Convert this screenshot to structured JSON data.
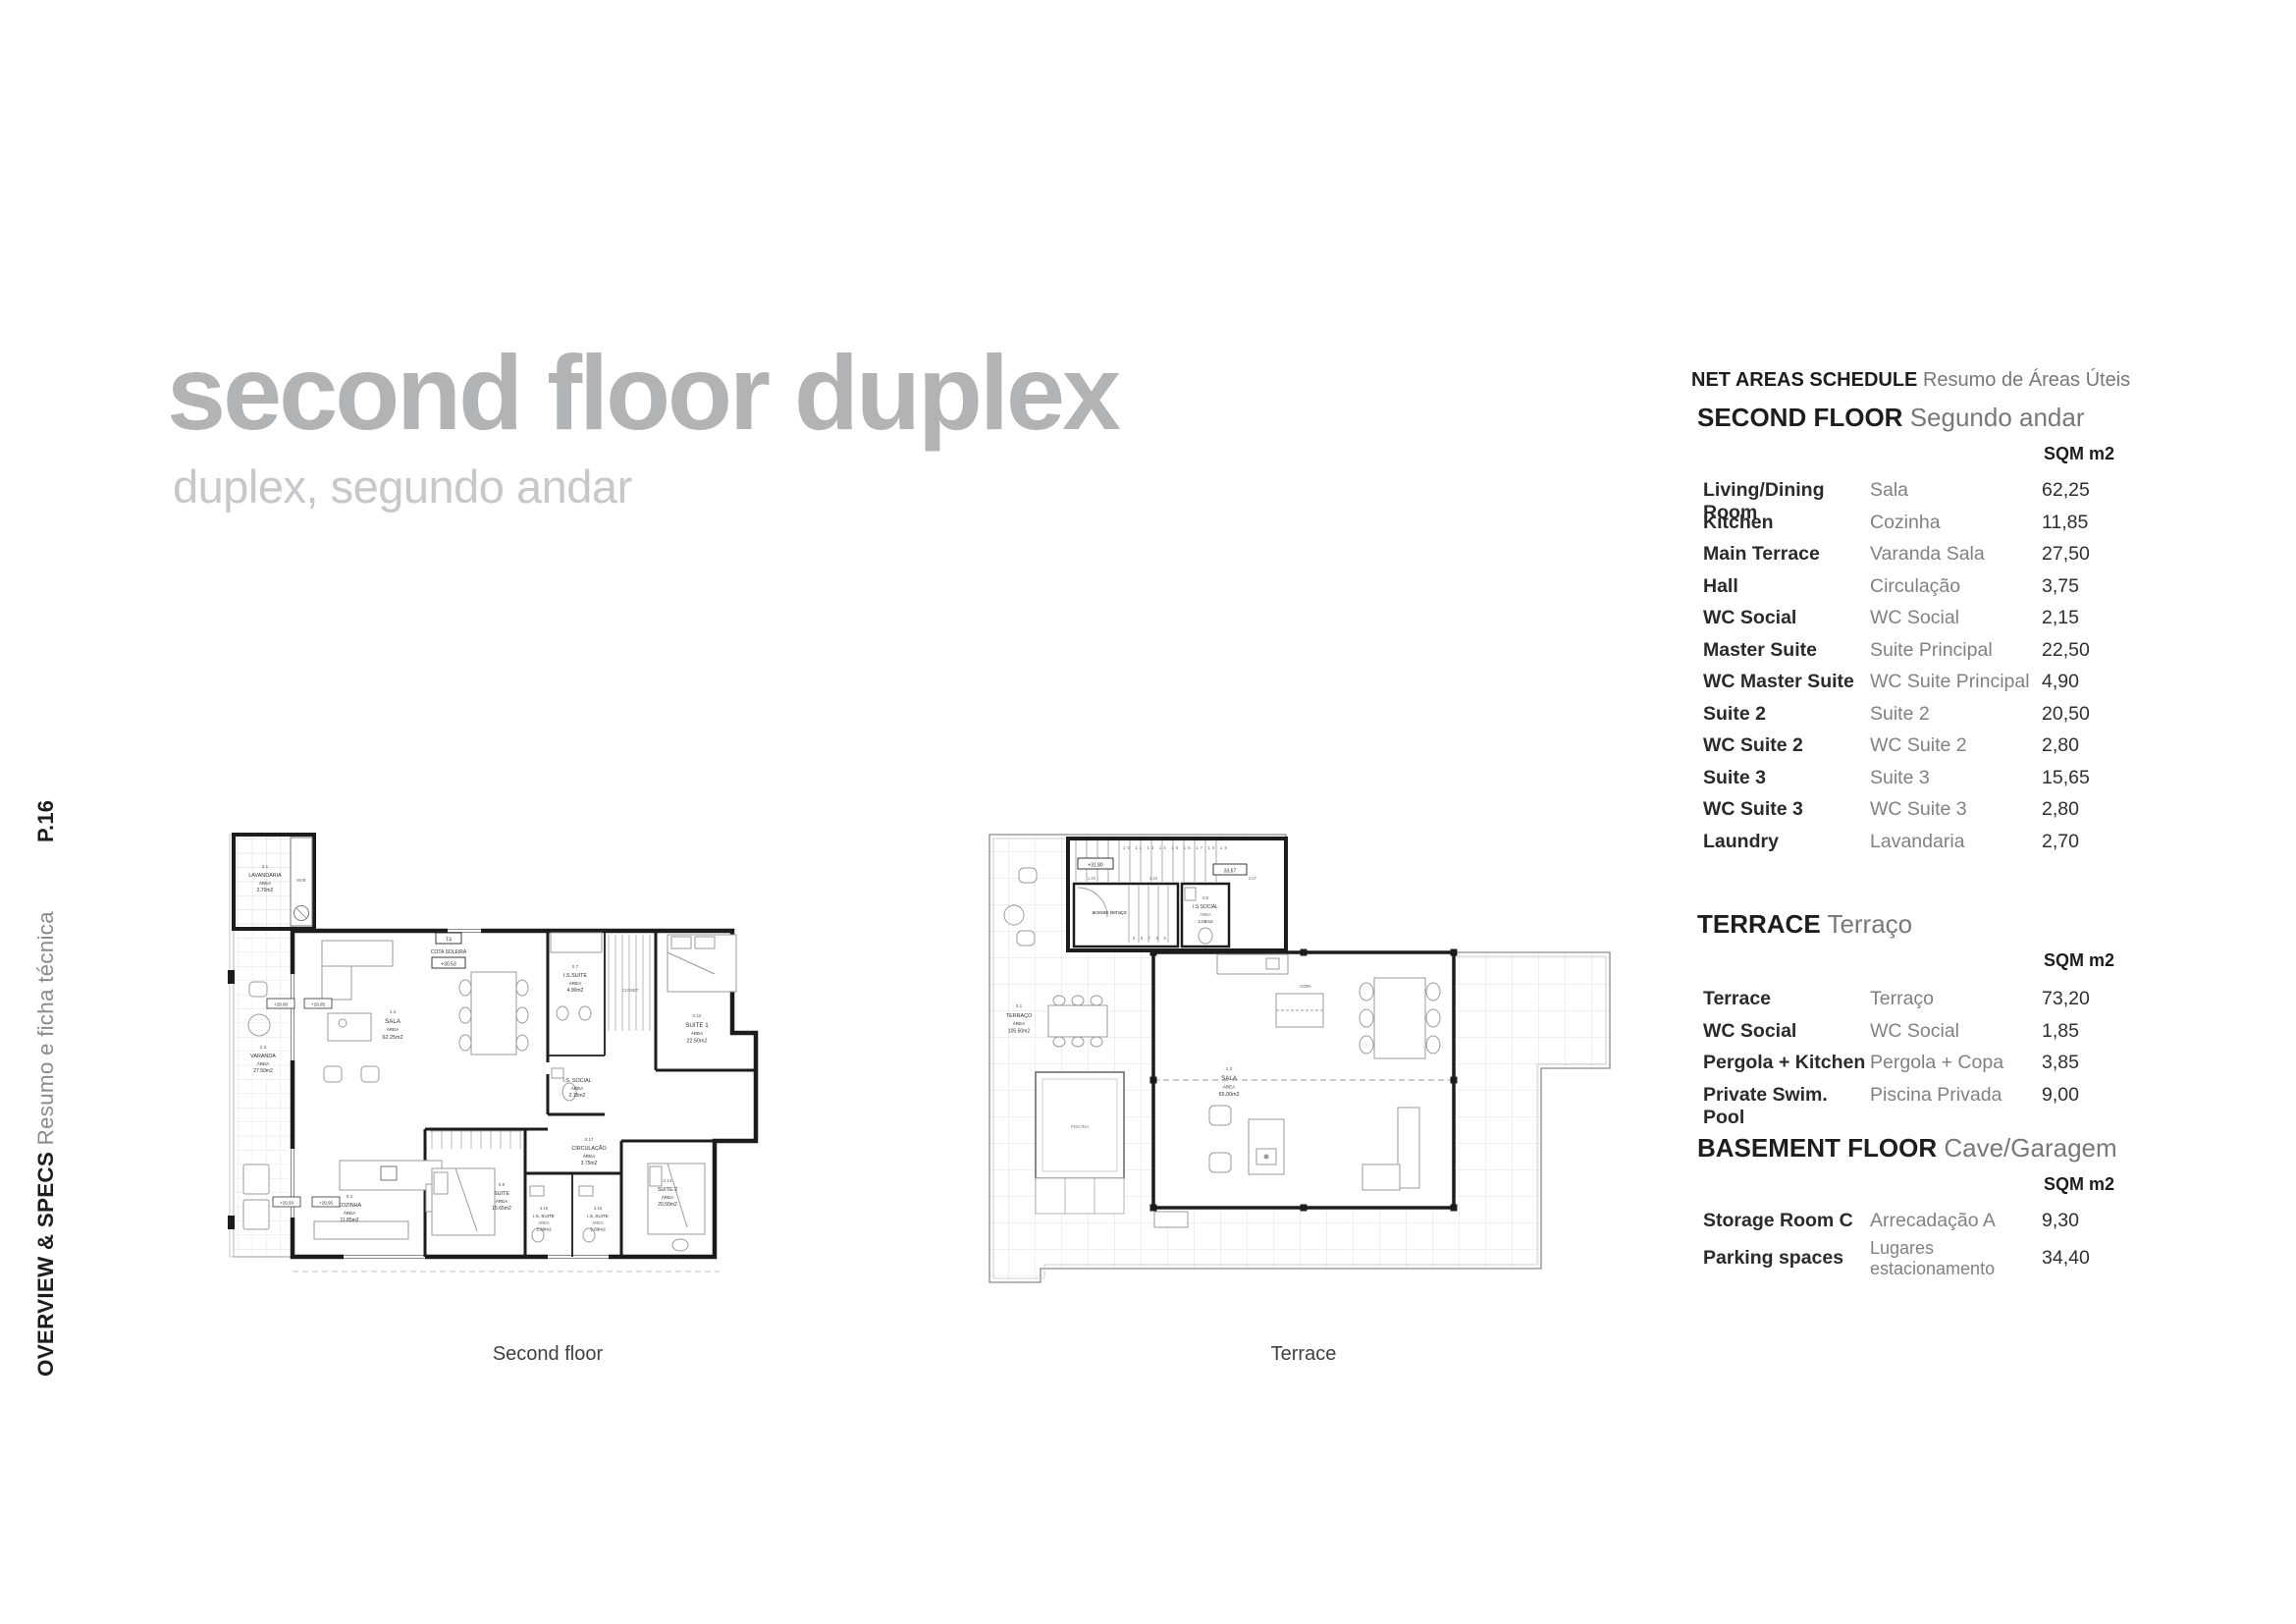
{
  "sidebar": {
    "page_number": "P.16",
    "section_title_en": "OVERVIEW & SPECS",
    "section_title_pt": "Resumo e ficha técnica"
  },
  "header": {
    "title": "second floor duplex",
    "subtitle": "duplex, segundo andar"
  },
  "plans": {
    "area_word": "ÁREA",
    "second_floor": {
      "caption": "Second floor",
      "rooms": {
        "lavandaria": {
          "code": "3.1",
          "name": "LAVANDARIA",
          "area": "2.70m2"
        },
        "varanda": {
          "code": "2.3",
          "name": "VARANDA",
          "area": "27.50m2"
        },
        "sala": {
          "code": "1.3",
          "name": "SALA",
          "area": "62.25m2"
        },
        "is_suite": {
          "code": "0.7",
          "name": "I.S.SUITE",
          "area": "4.90m2"
        },
        "closet": {
          "name": "CLOSET"
        },
        "suite1": {
          "code": "0.12",
          "name": "SUITE 1",
          "area": "22.50m2"
        },
        "is_social": {
          "name": "I.S. SOCIAL",
          "area": "2.15m2"
        },
        "circulacao": {
          "code": "3.17",
          "name": "CIRCULAÇÃO",
          "area": "3.75m2"
        },
        "cozinha": {
          "code": "0.4",
          "name": "COZINHA",
          "area": "11.85m2"
        },
        "suite3": {
          "code": "0.9",
          "name": "SUITE",
          "area": "15.65m2"
        },
        "is_suite_a": {
          "code": "3.16",
          "name": "I.S. SUITE",
          "area": "2.80m2"
        },
        "is_suite_b": {
          "code": "3.15",
          "name": "I.S. SUITE",
          "area": "2.80m2"
        },
        "suite2": {
          "code": "2.14",
          "name": "SUITE 2",
          "area": "20.50m2"
        },
        "mur": "MUR"
      },
      "markers": {
        "cota_type": "T4",
        "cota_label": "COTA SOLEIRA",
        "cota_value": "+30.53",
        "level_a": "+29.93",
        "level_b": "+29.95"
      }
    },
    "terrace": {
      "caption": "Terrace",
      "rooms": {
        "terraco": {
          "code": "3.1",
          "name": "TERRAÇO",
          "area": "105.50m2"
        },
        "sala": {
          "code": "1.3",
          "name": "SALA",
          "area": "65,00m2"
        },
        "is_social": {
          "code": "0.5",
          "name": "I.S SOCIAL",
          "area": "2.05m2"
        },
        "acesso": {
          "name": "acesso terraço"
        },
        "copa": {
          "name": "COPA"
        },
        "piscina": {
          "name": "PISCINA"
        }
      },
      "markers": {
        "level": "+31.80",
        "dim_total": "33,67",
        "dim1": "1.20",
        "dim2": "2.40",
        "dim3": "2.67",
        "stair_numbers_top": "10 11 13 14 15 16 17 18 19",
        "stair_numbers_bottom": "9 8 7 6 5"
      }
    }
  },
  "schedule": {
    "title_en": "NET AREAS SCHEDULE",
    "title_pt": "Resumo de Áreas Úteis",
    "unit_label": "SQM m2",
    "sections": [
      {
        "heading_en": "SECOND FLOOR",
        "heading_pt": "Segundo andar",
        "rows": [
          {
            "en": "Living/Dining Room",
            "pt": "Sala",
            "sqm": "62,25"
          },
          {
            "en": "Kitchen",
            "pt": "Cozinha",
            "sqm": "11,85"
          },
          {
            "en": "Main Terrace",
            "pt": "Varanda Sala",
            "sqm": "27,50"
          },
          {
            "en": "Hall",
            "pt": "Circulação",
            "sqm": "3,75"
          },
          {
            "en": "WC Social",
            "pt": "WC Social",
            "sqm": "2,15"
          },
          {
            "en": "Master Suite",
            "pt": "Suite Principal",
            "sqm": "22,50"
          },
          {
            "en": "WC Master Suite",
            "pt": "WC Suite Principal",
            "sqm": "4,90"
          },
          {
            "en": "Suite 2",
            "pt": "Suite 2",
            "sqm": "20,50"
          },
          {
            "en": "WC Suite 2",
            "pt": "WC Suite 2",
            "sqm": "2,80"
          },
          {
            "en": "Suite 3",
            "pt": "Suite 3",
            "sqm": "15,65"
          },
          {
            "en": "WC Suite 3",
            "pt": "WC Suite 3",
            "sqm": "2,80"
          },
          {
            "en": "Laundry",
            "pt": "Lavandaria",
            "sqm": "2,70"
          }
        ]
      },
      {
        "heading_en": "TERRACE",
        "heading_pt": "Terraço",
        "rows": [
          {
            "en": "Terrace",
            "pt": "Terraço",
            "sqm": "73,20"
          },
          {
            "en": "WC Social",
            "pt": "WC Social",
            "sqm": "1,85"
          },
          {
            "en": "Pergola + Kitchen",
            "pt": "Pergola + Copa",
            "sqm": "3,85"
          },
          {
            "en": "Private Swim. Pool",
            "pt": "Piscina Privada",
            "sqm": "9,00"
          }
        ]
      },
      {
        "heading_en": "BASEMENT FLOOR",
        "heading_pt": "Cave/Garagem",
        "rows": [
          {
            "en": "Storage Room C",
            "pt": "Arrecadação A",
            "sqm": "9,30"
          },
          {
            "en": "Parking spaces",
            "pt": "Lugares estacionamento",
            "sqm": "34,40"
          }
        ]
      }
    ]
  }
}
